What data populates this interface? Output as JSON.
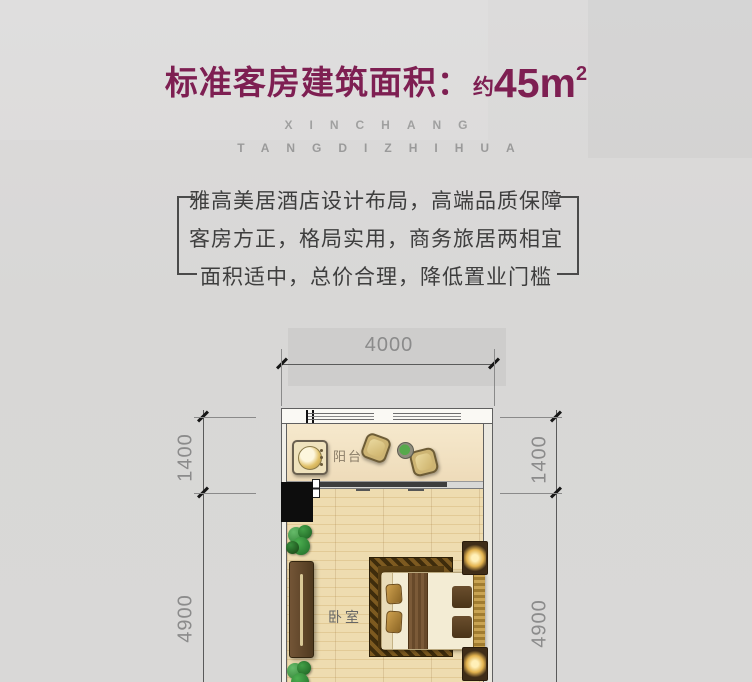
{
  "header": {
    "title_main": "标准客房建筑面积：",
    "title_approx": "约",
    "title_value": "45m",
    "title_sup": "2",
    "accent_color": "#7e1f52",
    "watermark_line1": "XINCHANG",
    "watermark_line2": "TANGDIZHIHUA"
  },
  "selling_points": [
    "雅高美居酒店设计布局，高端品质保障",
    "客房方正，格局实用，商务旅居两相宜",
    "面积适中，总价合理，降低置业门槛"
  ],
  "floorplan": {
    "dim_top": "4000",
    "dim_left_upper": "1400",
    "dim_left_lower": "4900",
    "dim_right_upper": "1400",
    "dim_right_lower": "4900",
    "room_balcony": "阳台",
    "room_bedroom": "卧室"
  },
  "colors": {
    "background": "#d8d7d6",
    "title_accent": "#7e1f52",
    "body_text": "#3e3e3e",
    "dimension_gray": "#8b8b8b",
    "wood_floor": "#e9d5a9",
    "balcony_floor": "#f3e4c6"
  }
}
